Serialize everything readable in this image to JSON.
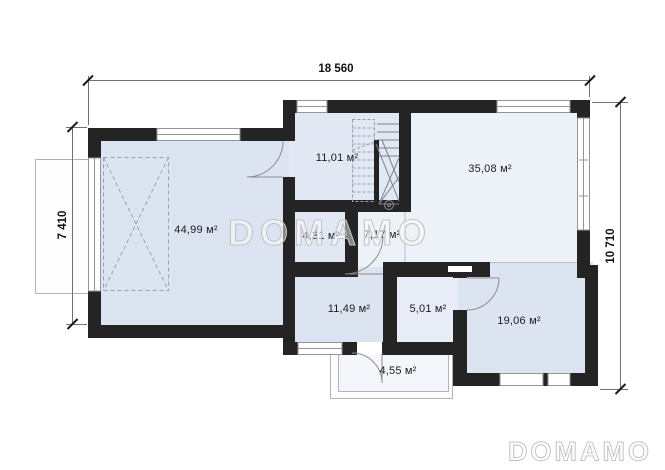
{
  "watermarks": {
    "center": "DOMAMO",
    "corner": "DOMAMO"
  },
  "dimensions": {
    "top": "18 560",
    "left": "7 410",
    "right": "10 710"
  },
  "rooms": [
    {
      "id": "garage",
      "area": "44,99 м²"
    },
    {
      "id": "hall",
      "area": "11,01 м²"
    },
    {
      "id": "living-room",
      "area": "35,08 м²"
    },
    {
      "id": "bathroom",
      "area": "4,31 м²"
    },
    {
      "id": "corridor",
      "area": "7,17 м²"
    },
    {
      "id": "room",
      "area": "11,49 м²"
    },
    {
      "id": "pantry",
      "area": "5,01 м²"
    },
    {
      "id": "bedroom",
      "area": "19,06 м²"
    },
    {
      "id": "porch",
      "area": "4,55 м²"
    }
  ],
  "colors": {
    "wall": "#242424",
    "dim-line": "#6f6f6f",
    "label-text": "#1b1b1b",
    "watermark": "#c4c4c4",
    "window-frame": "#949494",
    "thin-line": "#b9c0cc",
    "fill-a": "#edf1f8",
    "fill-b": "#e2e8f3",
    "fill-c": "#dde4f1",
    "fill-d": "#e7ecf6",
    "fill-e": "#f4f6fb"
  }
}
